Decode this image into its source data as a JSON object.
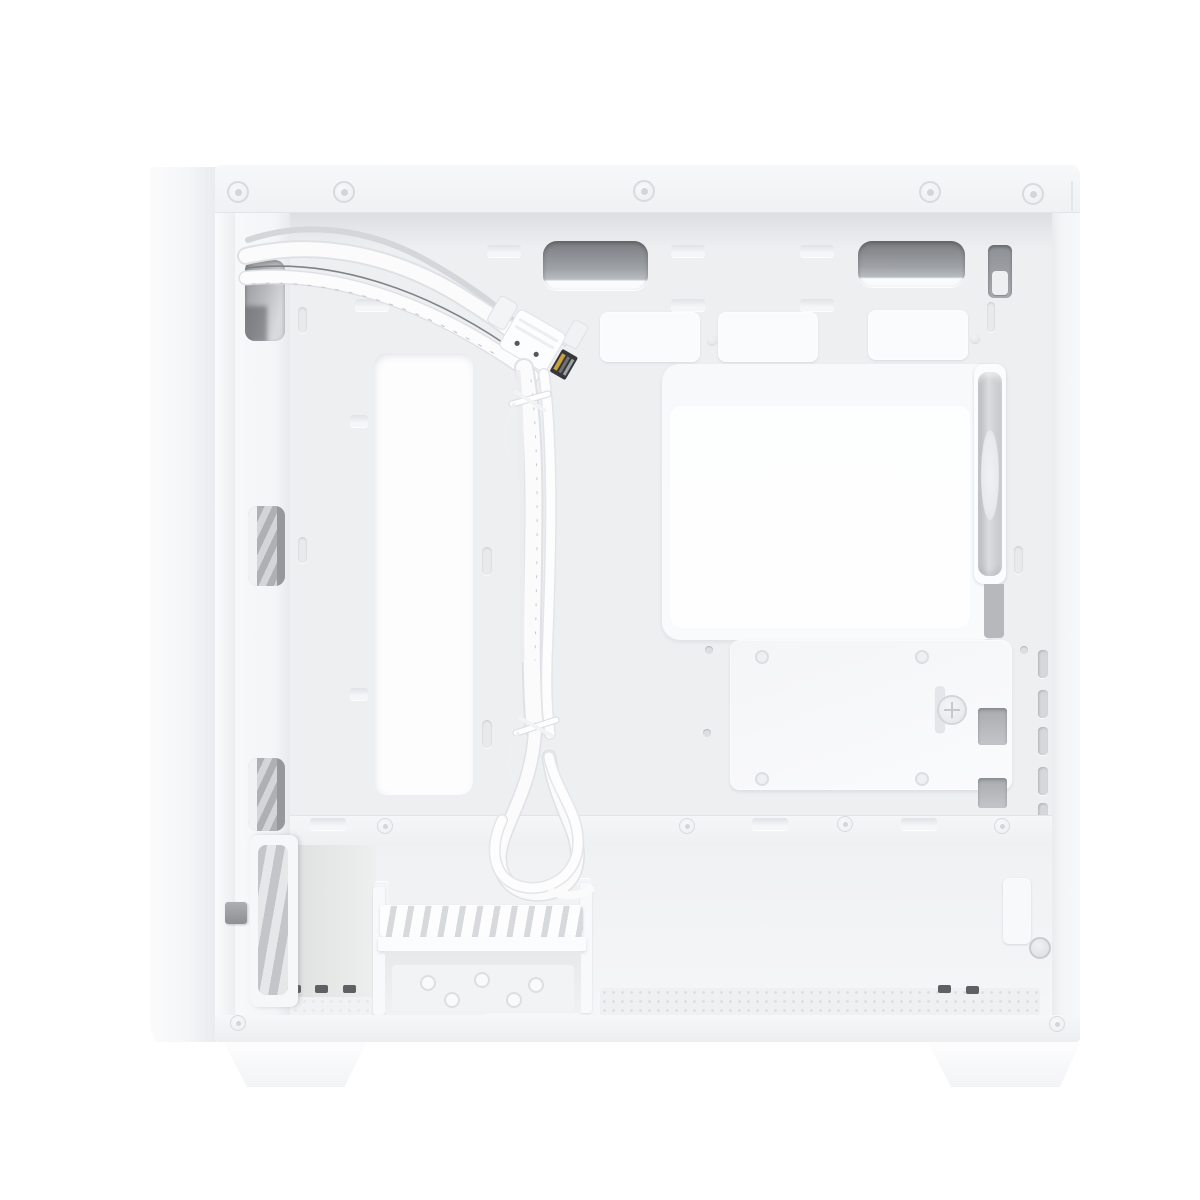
{
  "image": {
    "alt": "Product photo of a white micro-ATX PC case interior, right side panel removed, showing white front-panel cables routed through a grommet, motherboard tray cutouts, SSD mounting plate with thumbscrew, rear exhaust fan, drive cage and mesh bottom filter, standing on two trapezoidal feet."
  },
  "parts": {
    "front_panel_slab": "front panel outer slab",
    "top_frame": "top frame rail with rivets",
    "cable_grommets": "two dark cable pass-through slots",
    "cpu_cutout": "CPU cooler backplate cutout",
    "motherboard_panel": "stamped motherboard tray panel",
    "ssd_plate": "SSD mounting plate with latch thumbscrew",
    "rear_fan": "rear exhaust fan (edge view)",
    "expansion_slots": "expansion slot bracket notches",
    "front_cables": "white front-panel cable bundle with cable ties",
    "drive_cage": "vented drive cage",
    "bottom_filter": "perforated bottom dust filter",
    "case_feet": "two case feet"
  },
  "palette": {
    "bg": "#ffffff",
    "slab-light": "#fbfbfc",
    "slab-shade": "#e9ebee",
    "case-base": "#f2f3f5",
    "frame-top": "#f7f8fa",
    "interior": "#edeff1",
    "stamp-light": "#fafbfd",
    "panel-light": "#f8f9fb",
    "cutout-light": "#fdfdfe",
    "slot-dark": "#797c80",
    "slot-mid": "#9da0a4",
    "fan-hub": "#e9eaec",
    "gray-part": "#b6b8bb",
    "dark-part": "#5e6063",
    "mesh-dot": "#dcdee0",
    "cable-white": "#fbfbfc",
    "cable-shadow": "#dfe1e4",
    "wire-dark": "#77797c",
    "screw-ring": "#d8dadd",
    "edge-line": "#e2e4e7"
  }
}
